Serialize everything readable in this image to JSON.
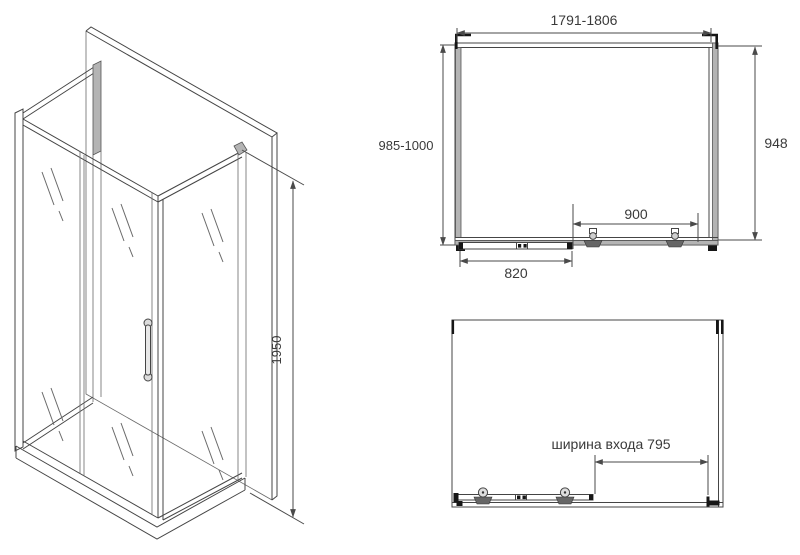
{
  "colors": {
    "line": "#454545",
    "profile_gray": "#b4b4b4",
    "roller_gray": "#666666",
    "bracket_black": "#161616",
    "text": "#3a3a3a",
    "background": "#ffffff"
  },
  "isometric_view": {
    "height_dim": "1950"
  },
  "front_view": {
    "width_dim": "1791-1806",
    "left_depth_dim": "985-1000",
    "right_depth_dim": "948",
    "roller_span_dim": "900",
    "door_panel_dim": "820"
  },
  "plan_view": {
    "entrance_width_dim": "ширина входа 795"
  }
}
